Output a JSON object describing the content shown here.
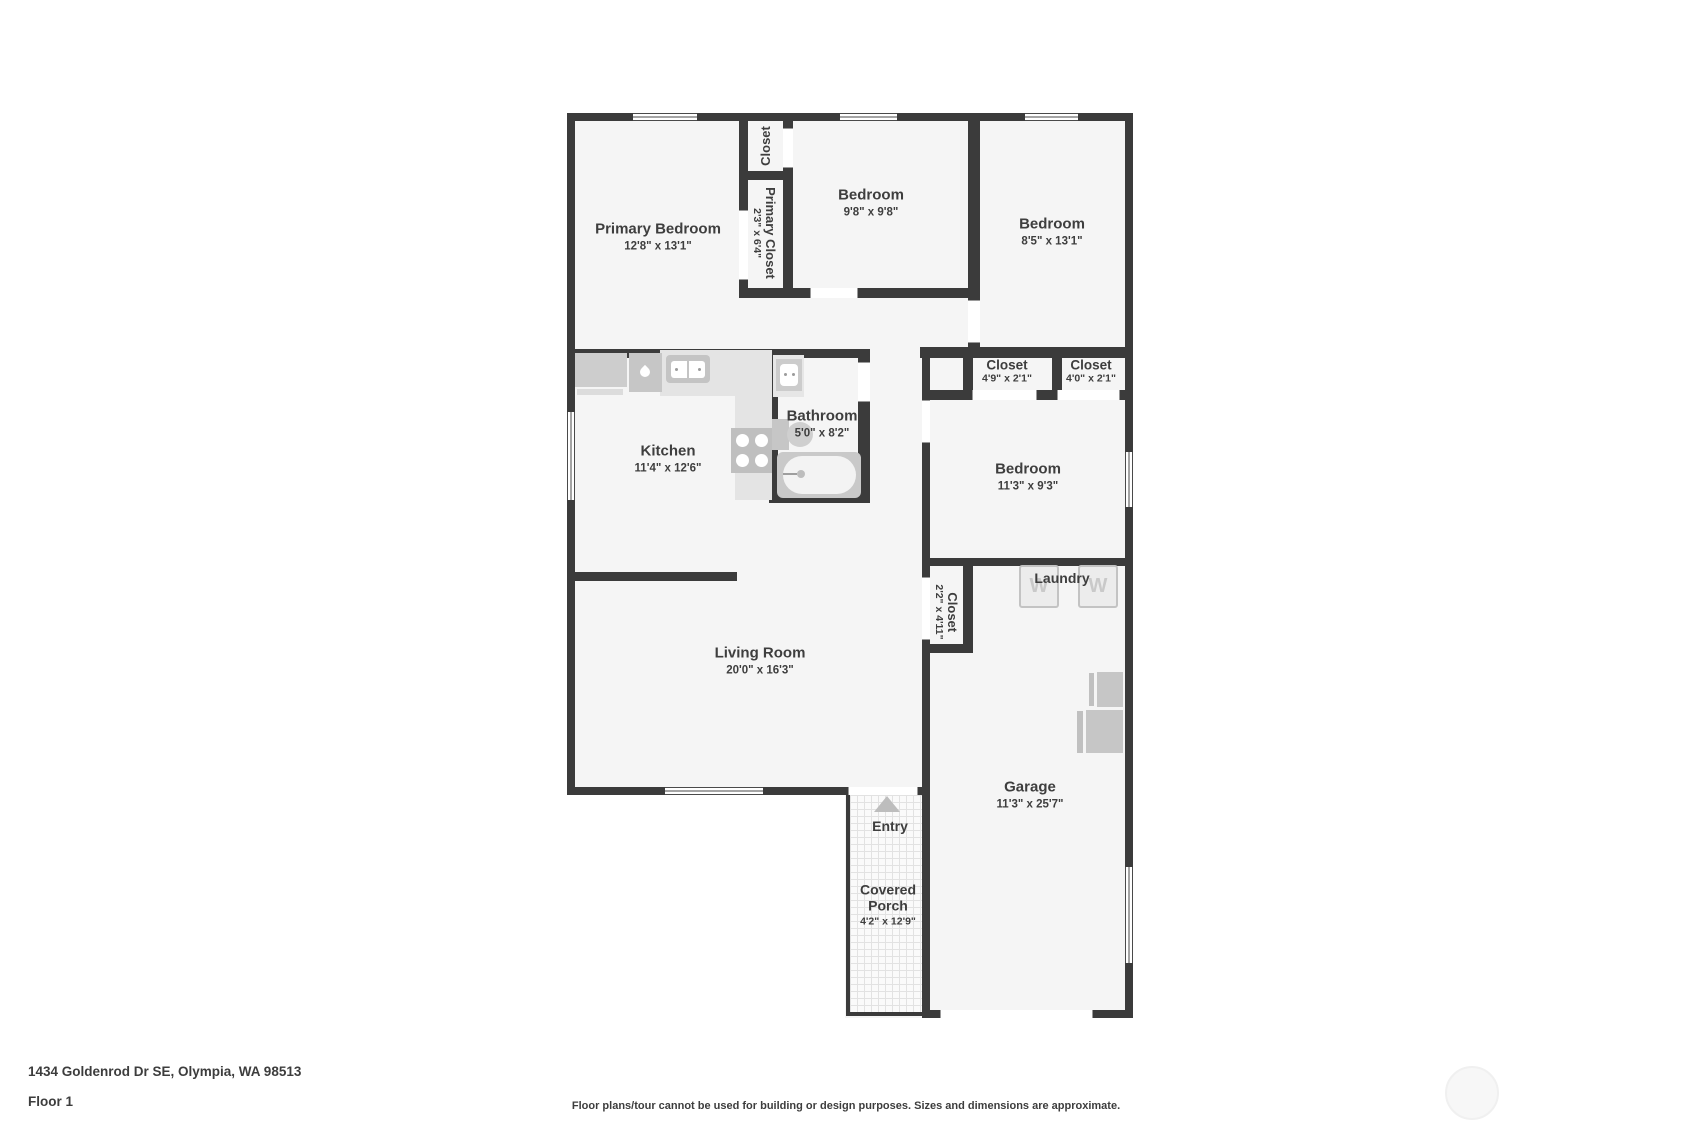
{
  "plan": {
    "rooms": {
      "primary_bedroom": {
        "name": "Primary Bedroom",
        "dims": "12'8\" x 13'1\""
      },
      "closet_top": {
        "name": "Closet"
      },
      "primary_closet": {
        "name": "Primary Closet",
        "dims": "2'3\" x 6'4\""
      },
      "bedroom_2": {
        "name": "Bedroom",
        "dims": "9'8\" x 9'8\""
      },
      "bedroom_3": {
        "name": "Bedroom",
        "dims": "8'5\" x 13'1\""
      },
      "closet_1": {
        "name": "Closet",
        "dims": "4'9\" x 2'1\""
      },
      "closet_2": {
        "name": "Closet",
        "dims": "4'0\" x 2'1\""
      },
      "kitchen": {
        "name": "Kitchen",
        "dims": "11'4\" x 12'6\""
      },
      "bathroom": {
        "name": "Bathroom",
        "dims": "5'0\" x 8'2\""
      },
      "bedroom_4": {
        "name": "Bedroom",
        "dims": "11'3\" x 9'3\""
      },
      "closet_3": {
        "name": "Closet",
        "dims": "2'2\" x 4'11\""
      },
      "laundry": {
        "name": "Laundry"
      },
      "living_room": {
        "name": "Living Room",
        "dims": "20'0\" x 16'3\""
      },
      "garage": {
        "name": "Garage",
        "dims": "11'3\" x 25'7\""
      },
      "entry": {
        "name": "Entry"
      },
      "covered_porch": {
        "name": "Covered Porch",
        "dims": "4'2\" x 12'9\""
      }
    },
    "appliance_labels": {
      "washer": "W"
    }
  },
  "footer": {
    "address": "1434 Goldenrod Dr SE, Olympia, WA 98513",
    "floor": "Floor 1",
    "disclaimer": "Floor plans/tour cannot be used for building or design purposes. Sizes and dimensions are approximate."
  },
  "colors": {
    "wall": "#3b3b3b",
    "floor": "#f5f5f5",
    "fixture": "#c9c9c9",
    "counter": "#e4e4e4",
    "text": "#3e3e3e"
  }
}
